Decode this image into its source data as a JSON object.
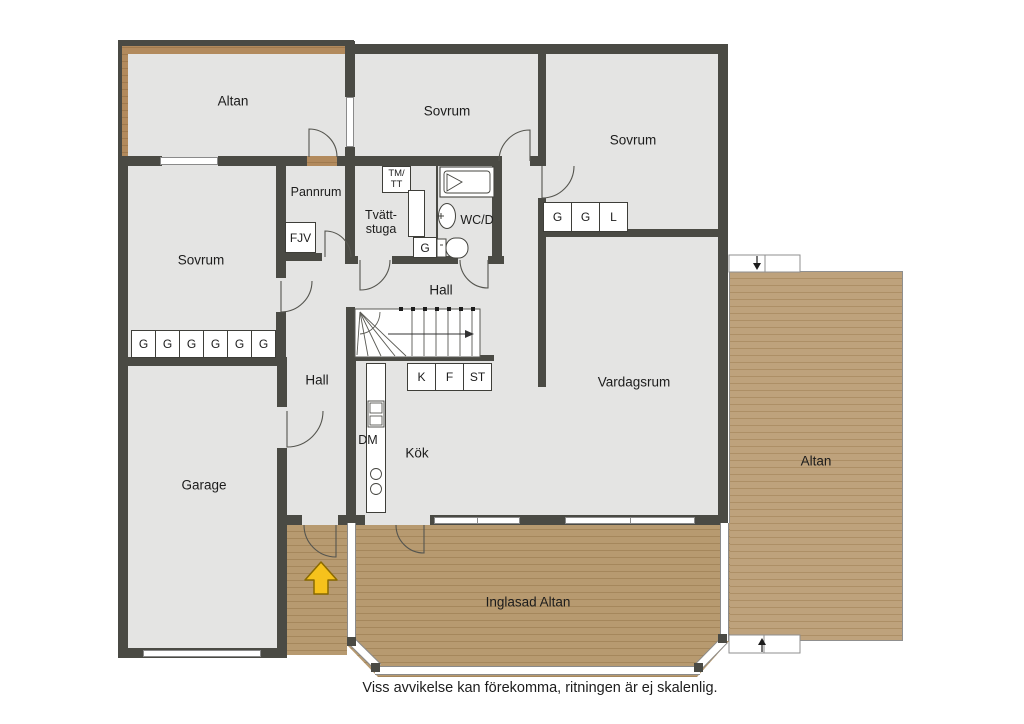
{
  "meta": {
    "disclaimer": "Viss avvikelse kan förekomma, ritningen är ej skalenlig."
  },
  "rooms": {
    "altan_top": "Altan",
    "sovrum_top": "Sovrum",
    "sovrum_right": "Sovrum",
    "sovrum_left": "Sovrum",
    "pannrum": "Pannrum",
    "tvattstuga_line1": "Tvätt-",
    "tvattstuga_line2": "stuga",
    "wc": "WC/D",
    "hall_upper": "Hall",
    "hall_lower": "Hall",
    "kok": "Kök",
    "vardagsrum": "Vardagsrum",
    "garage": "Garage",
    "altan_right": "Altan",
    "inglasad_altan": "Inglasad Altan"
  },
  "fixtures": {
    "fjv": "FJV",
    "tm_tt_line1": "TM/",
    "tm_tt_line2": "TT",
    "g_laundry": "G",
    "dm": "DM",
    "closets_bedroom_right": [
      "G",
      "G",
      "L"
    ],
    "closets_bedroom_left": [
      "G",
      "G",
      "G",
      "G",
      "G",
      "G"
    ],
    "kitchen_units": [
      "K",
      "F",
      "ST"
    ]
  },
  "colors": {
    "wall": "#4A4A44",
    "floor": "#E4E4E3",
    "deck_light": "#BEA27C",
    "deck_dark": "#B28A5D",
    "plank_line": "#A5875C",
    "glazing_edge": "#8A8A8A",
    "entrance_arrow": "#F6C21C",
    "text": "#1C1C1C"
  }
}
